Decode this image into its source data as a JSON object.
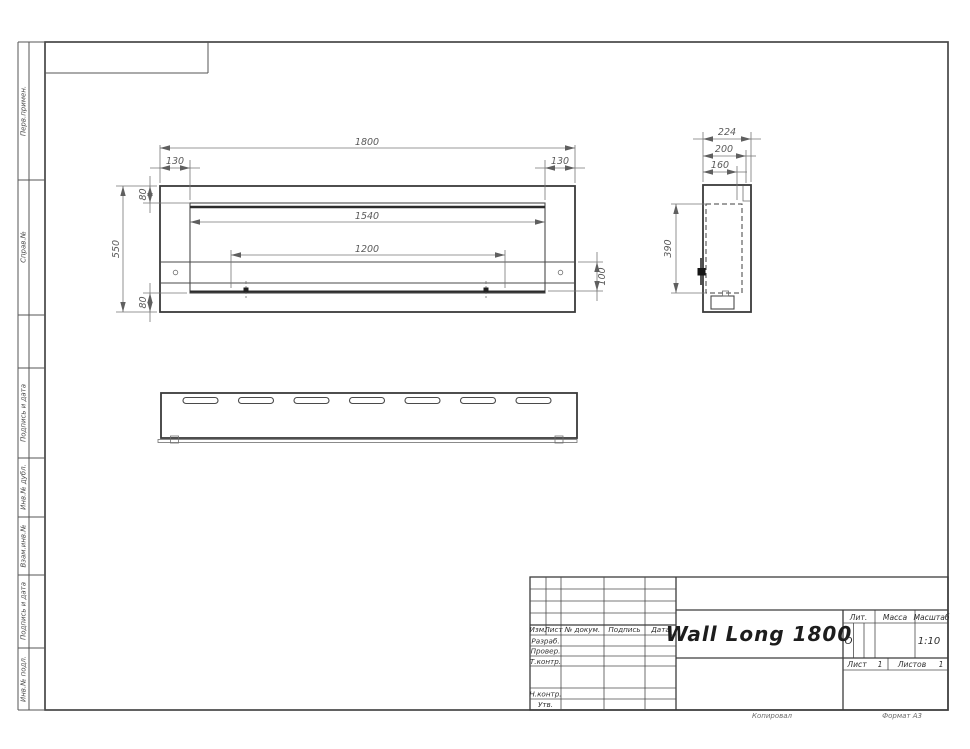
{
  "margin": {
    "labels": [
      "Перв.примен.",
      "Справ.№",
      "Подпись и дата",
      "Инв.№ дубл.",
      "Взам.инв.№",
      "Подпись и дата",
      "Инв.№ подл."
    ]
  },
  "dimensions": {
    "front": {
      "total_width": "1800",
      "inset_left": "130",
      "inset_right": "130",
      "top_offset": "80",
      "height": "550",
      "opening_width": "1540",
      "burner_length": "1200",
      "band_height": "100",
      "bottom_offset": "80"
    },
    "side": {
      "depth": "224",
      "depth_mid": "200",
      "depth_inner": "160",
      "inner_height": "390"
    }
  },
  "title_block": {
    "product_name": "Wall Long 1800",
    "header_cols": [
      "Изм.",
      "Лист",
      "№ докум.",
      "Подпись",
      "Дата"
    ],
    "role_rows": [
      "Разраб.",
      "Провер.",
      "Т.контр.",
      "Н.контр.",
      "Утв."
    ],
    "lit_label": "Лит.",
    "lit_value": "О",
    "mass_label": "Масса",
    "scale_label": "Масштаб",
    "scale_value": "1:10",
    "sheet_label": "Лист",
    "sheet_value": "1",
    "sheets_label": "Листов",
    "sheets_value": "1"
  },
  "footer": {
    "copy_note": "Копировал",
    "format_note": "Формат А3"
  }
}
